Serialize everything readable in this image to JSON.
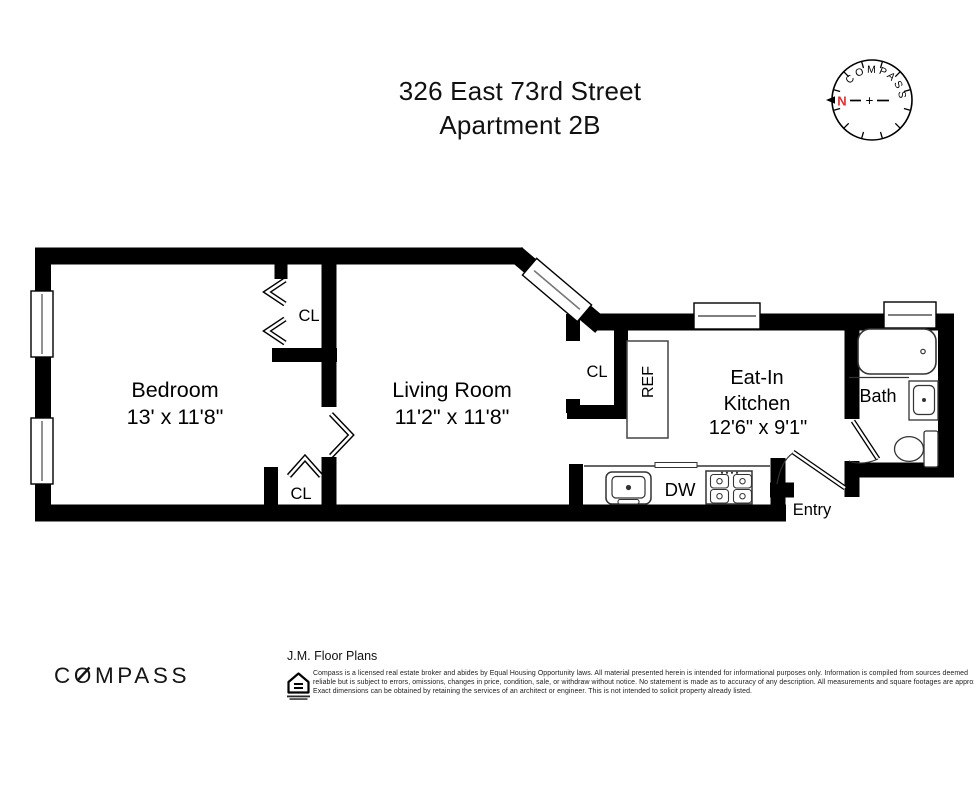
{
  "title": {
    "line1": "326 East 73rd Street",
    "line2": "Apartment 2B"
  },
  "compass_rose": {
    "brand": "COMPASS",
    "north": "N",
    "plus": "+"
  },
  "rooms": {
    "bedroom": {
      "name": "Bedroom",
      "dims": "13' x 11'8\""
    },
    "living_room": {
      "name": "Living Room",
      "dims": "11'2\" x 11'8\""
    },
    "eat_in_kitchen": {
      "name_line1": "Eat-In",
      "name_line2": "Kitchen",
      "dims": "12'6\" x 9'1\""
    },
    "bath": {
      "name": "Bath"
    },
    "entry": {
      "name": "Entry"
    }
  },
  "fixtures": {
    "closet_abbr_top": "CL",
    "closet_abbr_bottom": "CL",
    "closet_abbr_kitchen": "CL",
    "refrigerator": "REF",
    "dishwasher": "DW"
  },
  "footer": {
    "brand_logo": "COMPASS",
    "credit": "J.M. Floor Plans",
    "disclaimer": [
      "Compass is a licensed real estate broker and abides by Equal Housing Opportunity laws. All material presented herein is intended for informational purposes only. Information is compiled from sources deemed",
      "reliable but is subject to errors, omissions, changes in price, condition, sale, or withdraw without notice. No statement is made as to accuracy of any description. All measurements and square footages are approximate.",
      "Exact dimensions can be obtained by retaining the services of an architect or engineer. This is not intended to solicit property already listed."
    ]
  },
  "colors": {
    "walls": "#000000",
    "north_red": "#e03030",
    "text": "#000000"
  }
}
